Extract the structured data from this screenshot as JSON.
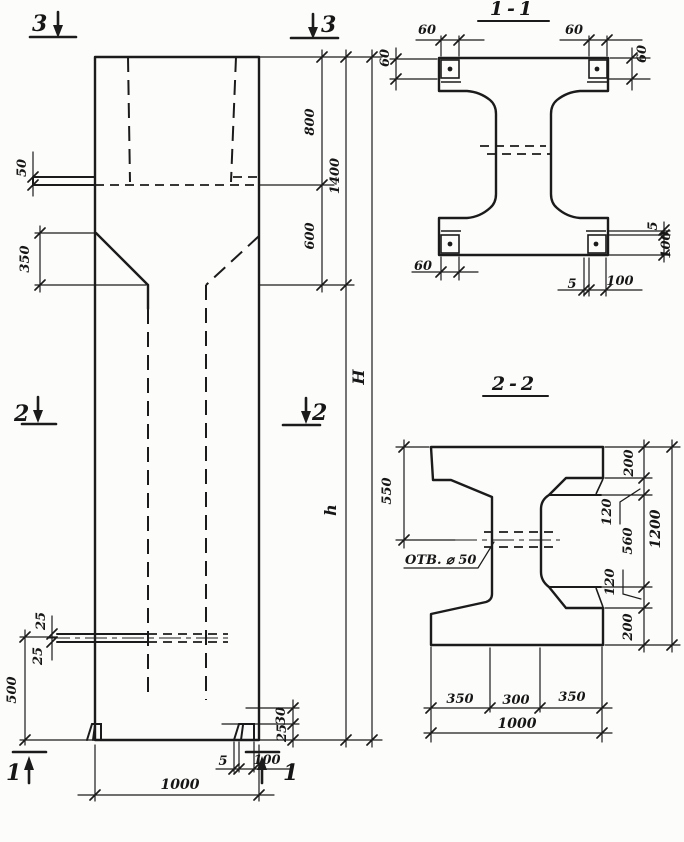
{
  "drawing": {
    "type": "structural concrete column working drawing, hand-drafted",
    "colors": {
      "ink": "#1b1b1b",
      "paper": "#fcfcfa"
    },
    "elevation": {
      "markers": {
        "m3l": "3",
        "m3r": "3",
        "m2l": "2",
        "m2r": "2",
        "m1l": "1",
        "m1r": "1"
      },
      "dims": {
        "d50": "50",
        "d350": "350",
        "d800": "800",
        "d1400": "1400",
        "d600": "600",
        "dH": "H",
        "dh": "h",
        "d25a": "25",
        "d25b": "25",
        "d500": "500",
        "d30": "30",
        "d25c": "25",
        "d5": "5",
        "d100": "100",
        "d1000": "1000"
      }
    },
    "section11": {
      "title": "1-1",
      "dims": {
        "tl60": "60",
        "tr60": "60",
        "lv60": "60",
        "rv60": "60",
        "bl60": "60",
        "b5": "5",
        "b100": "100",
        "r5": "5",
        "r100": "100"
      }
    },
    "section22": {
      "title": "2-2",
      "hole_label": "ОТВ. ⌀ 50",
      "dims": {
        "d550": "550",
        "t200": "200",
        "t120": "120",
        "d560": "560",
        "b120": "120",
        "b200": "200",
        "d1200": "1200",
        "l350": "350",
        "c300": "300",
        "r350": "350",
        "w1000": "1000"
      }
    }
  }
}
